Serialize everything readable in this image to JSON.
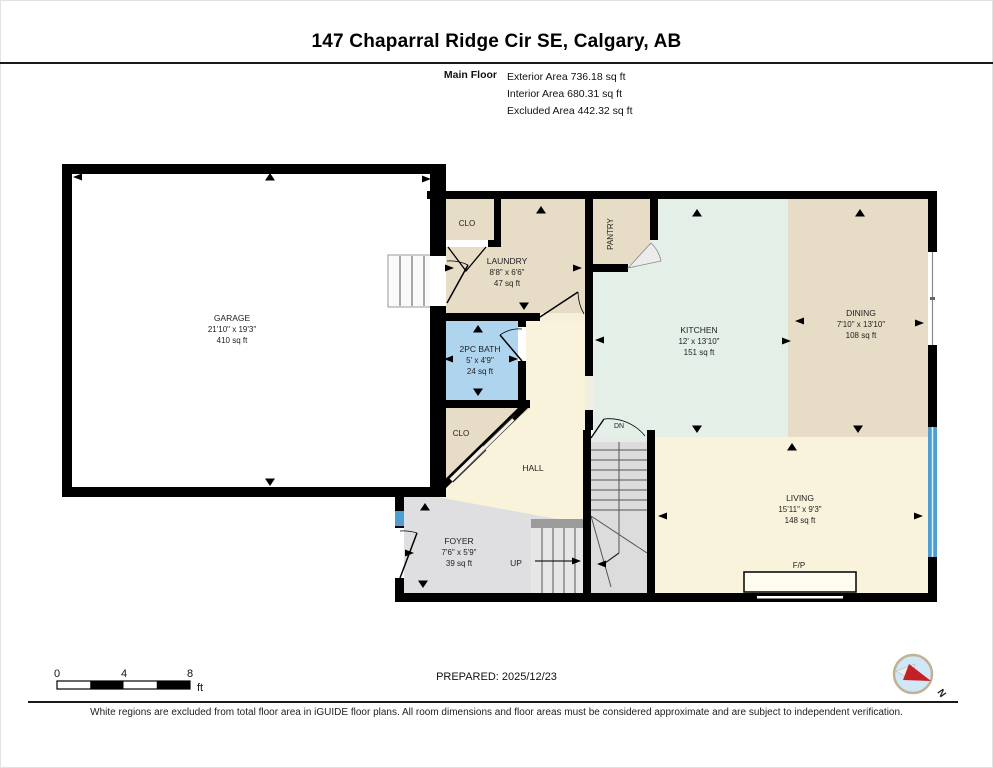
{
  "header": {
    "title": "147 Chaparral Ridge Cir SE, Calgary, AB",
    "floor_label": "Main Floor",
    "areas": {
      "exterior": "Exterior Area 736.18 sq ft",
      "interior": "Interior Area 680.31 sq ft",
      "excluded": "Excluded Area 442.32 sq ft"
    }
  },
  "rooms": {
    "garage": {
      "name": "GARAGE",
      "dims": "21'10\" x 19'3\"",
      "area": "410 sq ft"
    },
    "laundry": {
      "name": "LAUNDRY",
      "dims": "8'8\" x 6'6\"",
      "area": "47 sq ft"
    },
    "clo_upper": {
      "name": "CLO"
    },
    "pantry": {
      "name": "PANTRY"
    },
    "kitchen": {
      "name": "KITCHEN",
      "dims": "12' x 13'10\"",
      "area": "151 sq ft"
    },
    "dining": {
      "name": "DINING",
      "dims": "7'10\" x 13'10\"",
      "area": "108 sq ft"
    },
    "bath": {
      "name": "2PC BATH",
      "dims": "5' x 4'9\"",
      "area": "24 sq ft"
    },
    "clo_lower": {
      "name": "CLO"
    },
    "hall": {
      "name": "HALL"
    },
    "foyer": {
      "name": "FOYER",
      "dims": "7'6\" x 5'9\"",
      "area": "39 sq ft"
    },
    "living": {
      "name": "LIVING",
      "dims": "15'11\" x 9'3\"",
      "area": "148 sq ft"
    },
    "fireplace": {
      "name": "F/P"
    },
    "stairs_up": {
      "label": "UP"
    },
    "stairs_down": {
      "label": "DN"
    }
  },
  "scale_bar": {
    "tick_0": "0",
    "tick_4": "4",
    "tick_8": "8",
    "unit": "ft"
  },
  "footer": {
    "prepared": "PREPARED: 2025/12/23",
    "compass_north": "N",
    "disclaimer": "White regions are excluded from total floor area in iGUIDE floor plans. All room dimensions and floor areas must be considered approximate and are subject to independent verification."
  },
  "colors": {
    "room_tan": "#e7dcc6",
    "room_mint": "#e4efe8",
    "room_cream": "#faf3dc",
    "room_blue": "#aed4ee",
    "room_gray": "#dfdfe1",
    "stairs_gray": "#dcdcdc",
    "window_blue": "#4d9ed3",
    "wall_black": "#000000",
    "compass_red": "#c42127"
  }
}
